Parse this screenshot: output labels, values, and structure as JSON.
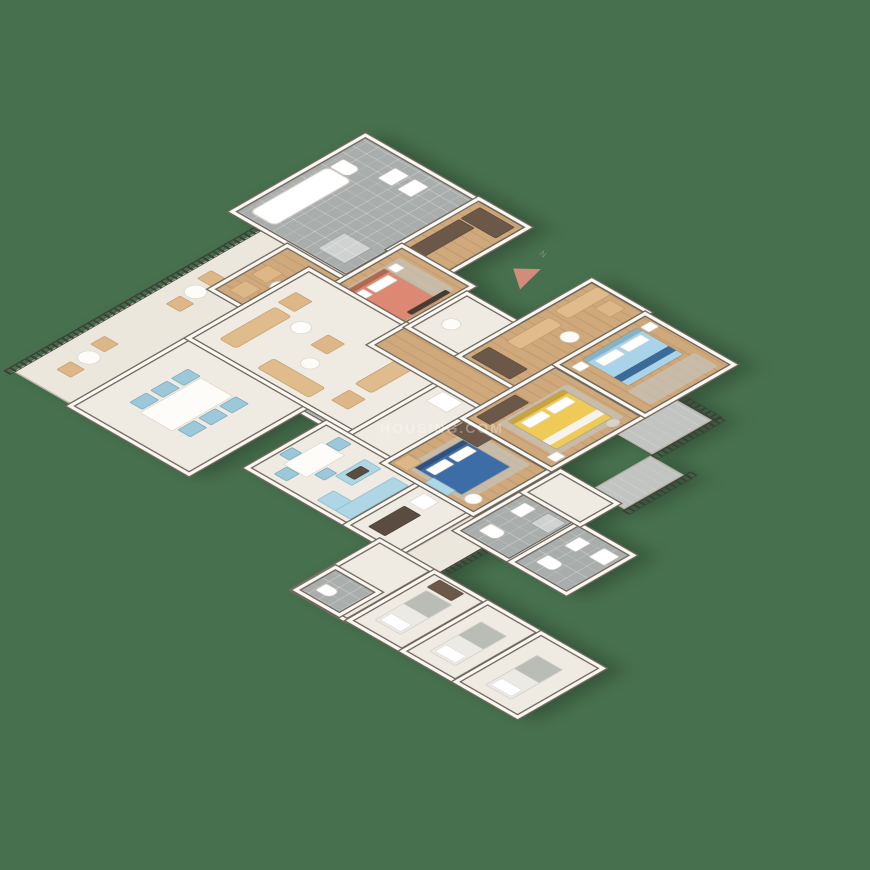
{
  "scene": {
    "type": "3d-isometric-floor-plan-render",
    "background_color": "#47714e",
    "watermark_text": "HOUSING.COM",
    "north_arrow_label": "N",
    "north_arrow_color": "#d18d7a"
  },
  "palette": {
    "bg": "#47714e",
    "wall-face": "#fbf8f3",
    "wall-line": "#6e675c",
    "floor-cream": "#f0ebe2",
    "floor-wood": "#cda57a",
    "floor-tile": "#a9adac",
    "balcony-floor": "#ece7dd",
    "railing": "#3c3f37",
    "sofa-beige": "#e0bb8c",
    "chair-blue": "#9cc8da",
    "bed-coral": "#dd8873",
    "bed-blue": "#3d6da6",
    "bed-yellow": "#efca56",
    "bed-lightblue": "#a9d3e8",
    "bed-white": "#eceae4",
    "wardrobe-brown": "#6b5848",
    "kitchen-cabinet": "#aed6e4",
    "rug-grey": "#c6c1b7"
  },
  "rooms": [
    {
      "id": "master-bathroom",
      "floor": "tile",
      "items": [
        "bathtub",
        "toilet",
        "sink",
        "sink"
      ]
    },
    {
      "id": "dressing-hall",
      "floor": "wood",
      "items": [
        "wardrobe",
        "wardrobe"
      ]
    },
    {
      "id": "master-sitting-area",
      "floor": "wood",
      "items": [
        "sofa",
        "armchair",
        "armchair",
        "round-coffee-table"
      ]
    },
    {
      "id": "master-bedroom",
      "floor": "wood",
      "items": [
        "double-bed-coral",
        "rug",
        "nightstand",
        "nightstand",
        "tv-unit"
      ]
    },
    {
      "id": "study",
      "floor": "wood",
      "items": [
        "desk",
        "chair"
      ]
    },
    {
      "id": "powder-room",
      "floor": "tile",
      "items": [
        "toilet",
        "sink"
      ]
    },
    {
      "id": "north-balcony",
      "floor": "stone",
      "items": [
        "railing",
        "bistro-table",
        "bistro-table",
        "chair",
        "chair",
        "chair",
        "chair"
      ]
    },
    {
      "id": "dining-room",
      "floor": "marble",
      "items": [
        "dining-table",
        "chair-blue",
        "chair-blue",
        "chair-blue",
        "chair-blue",
        "chair-blue",
        "chair-blue"
      ]
    },
    {
      "id": "lounge",
      "floor": "marble",
      "items": [
        "sofa",
        "sofa",
        "sofa",
        "armchair",
        "armchair",
        "armchair",
        "round-table",
        "round-table",
        "round-table"
      ]
    },
    {
      "id": "kitchen-hall",
      "floor": "marble",
      "items": [
        "fridge"
      ]
    },
    {
      "id": "kitchen",
      "floor": "marble",
      "items": [
        "breakfast-table",
        "chair-blue",
        "chair-blue",
        "chair-blue",
        "chair-blue",
        "island-counter",
        "counter",
        "counter"
      ]
    },
    {
      "id": "utility-room",
      "floor": "marble",
      "items": [
        "dark-counter",
        "appliance"
      ]
    },
    {
      "id": "south-balcony",
      "floor": "stone",
      "items": [
        "railing"
      ]
    },
    {
      "id": "corridor",
      "floor": "wood",
      "items": []
    },
    {
      "id": "foyer",
      "floor": "marble",
      "items": [
        "console-table"
      ]
    },
    {
      "id": "family-sitting",
      "floor": "wood",
      "items": [
        "wardrobe",
        "loveseat",
        "loveseat",
        "round-table",
        "armchair"
      ]
    },
    {
      "id": "bedroom-blue",
      "floor": "wood",
      "items": [
        "double-bed-blue",
        "rug",
        "wardrobe",
        "armchair",
        "blue-cabinet",
        "round-table"
      ]
    },
    {
      "id": "bedroom-yellow",
      "floor": "wood",
      "items": [
        "double-bed-yellow",
        "rug",
        "wardrobe",
        "stool",
        "nightstand"
      ]
    },
    {
      "id": "bedroom-lightblue",
      "floor": "wood",
      "items": [
        "double-bed-lightblue",
        "rug",
        "nightstand",
        "nightstand"
      ]
    },
    {
      "id": "bathroom-2",
      "floor": "tile",
      "items": [
        "toilet",
        "sink",
        "shower"
      ]
    },
    {
      "id": "bathroom-3",
      "floor": "tile",
      "items": [
        "toilet",
        "sink",
        "washer"
      ]
    },
    {
      "id": "bedroom-hall",
      "floor": "marble",
      "items": []
    },
    {
      "id": "east-balcony-1",
      "floor": "stone-tile",
      "items": [
        "railing"
      ]
    },
    {
      "id": "east-balcony-2",
      "floor": "stone-tile",
      "items": [
        "railing"
      ]
    },
    {
      "id": "staff-hall",
      "floor": "marble",
      "items": []
    },
    {
      "id": "staff-bathroom",
      "floor": "tile",
      "items": [
        "toilet"
      ]
    },
    {
      "id": "staff-room-1",
      "floor": "marble",
      "items": [
        "single-bed",
        "wardrobe"
      ]
    },
    {
      "id": "staff-room-2",
      "floor": "marble",
      "items": [
        "single-bed"
      ]
    },
    {
      "id": "staff-room-3",
      "floor": "marble",
      "items": [
        "single-bed"
      ]
    }
  ]
}
